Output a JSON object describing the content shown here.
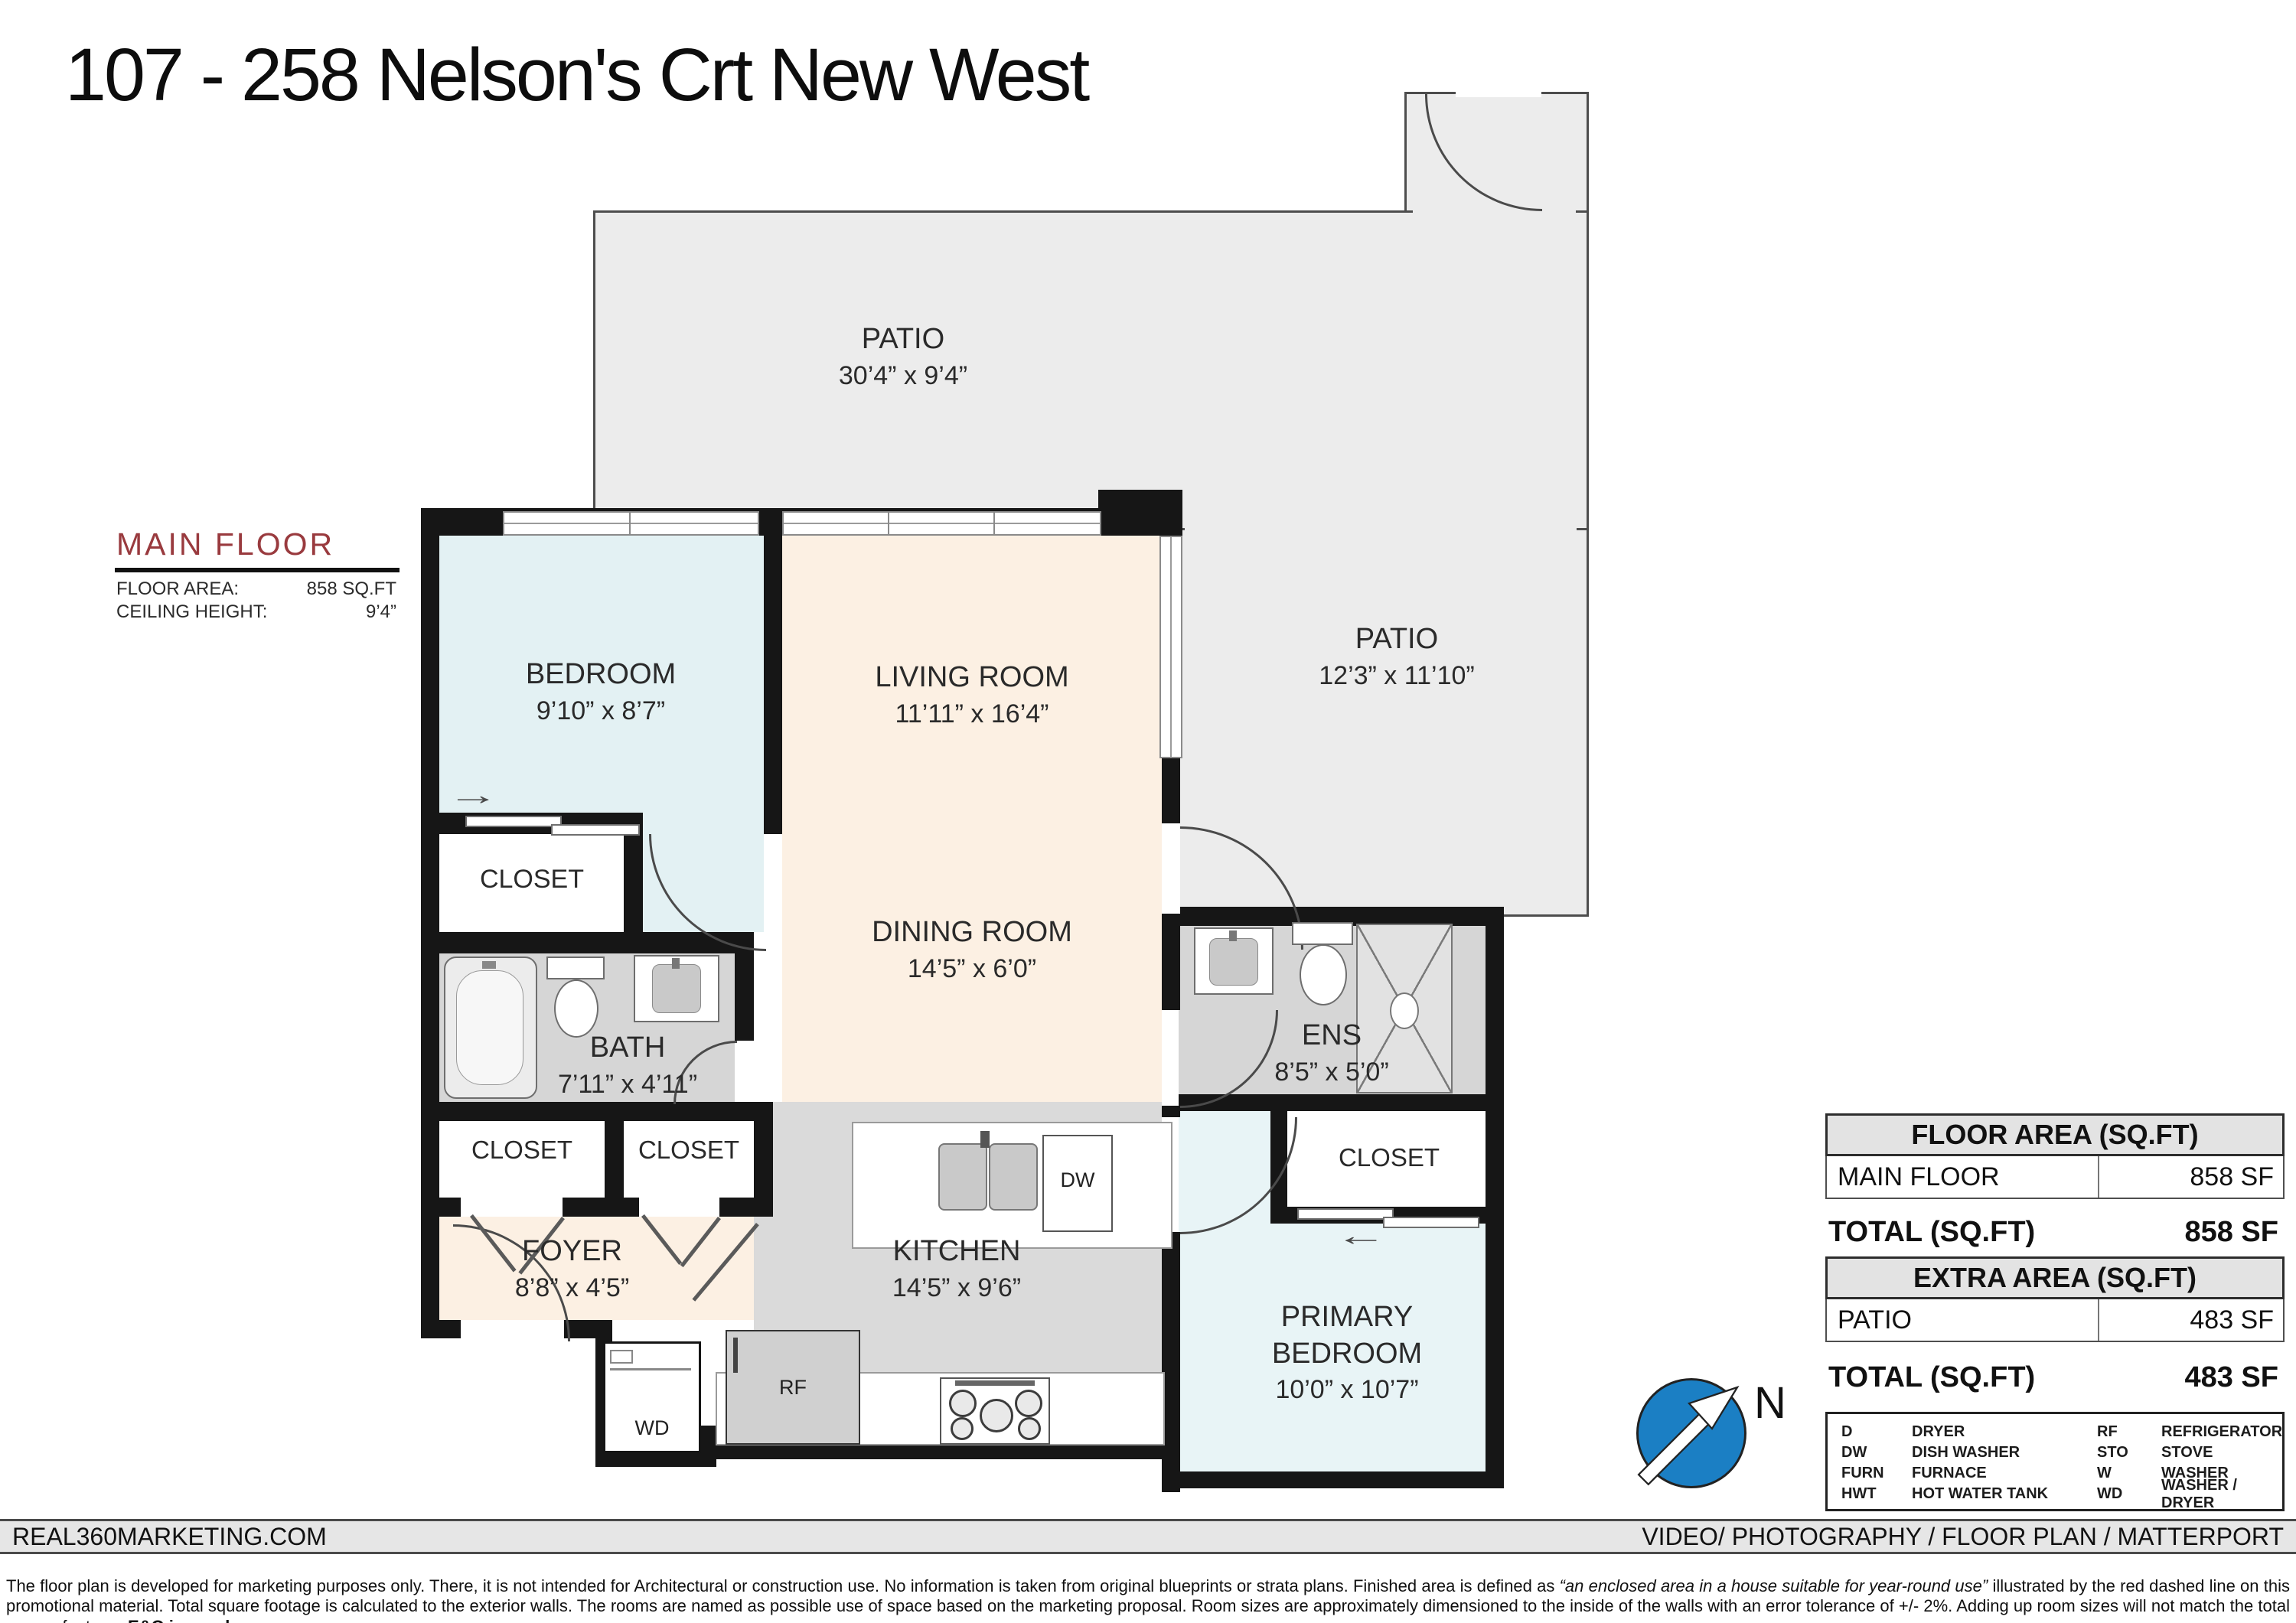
{
  "title": "107 - 258 Nelson's Crt New West",
  "floor_info": {
    "title": "MAIN FLOOR",
    "area_label": "FLOOR AREA:",
    "area_value": "858 SQ.FT",
    "ceiling_label": "CEILING HEIGHT:",
    "ceiling_value": "9’4”"
  },
  "rooms": {
    "patio_top": {
      "name": "PATIO",
      "dims": "30’4” x 9’4”"
    },
    "patio_right": {
      "name": "PATIO",
      "dims": "12’3” x 11’10”"
    },
    "bedroom": {
      "name": "BEDROOM",
      "dims": "9’10” x 8’7”"
    },
    "living_room": {
      "name": "LIVING ROOM",
      "dims": "11’11” x 16’4”"
    },
    "dining_room": {
      "name": "DINING ROOM",
      "dims": "14’5” x 6’0”"
    },
    "bath": {
      "name": "BATH",
      "dims": "7’11” x 4’11”"
    },
    "closet_bedroom": {
      "name": "CLOSET"
    },
    "closet_hall_1": {
      "name": "CLOSET"
    },
    "closet_hall_2": {
      "name": "CLOSET"
    },
    "foyer": {
      "name": "FOYER",
      "dims": "8’8” x 4’5”"
    },
    "kitchen": {
      "name": "KITCHEN",
      "dims": "14’5” x 9’6”"
    },
    "ens": {
      "name": "ENS",
      "dims": "8’5” x 5’0”"
    },
    "closet_primary": {
      "name": "CLOSET"
    },
    "primary_bedroom": {
      "name_line1": "PRIMARY",
      "name_line2": "BEDROOM",
      "dims": "10’0” x 10’7”"
    }
  },
  "appliances": {
    "wd": "WD",
    "rf": "RF",
    "dw": "DW"
  },
  "icons": {
    "slider_arrow_right": "→",
    "slider_arrow_left": "←"
  },
  "compass": {
    "north_label": "N"
  },
  "area_table": {
    "floor_header": "FLOOR AREA (SQ.FT)",
    "main_row": {
      "label": "MAIN FLOOR",
      "value": "858 SF"
    },
    "total1_label": "TOTAL (SQ.FT)",
    "total1_value": "858 SF",
    "extra_header": "EXTRA AREA (SQ.FT)",
    "patio_row": {
      "label": "PATIO",
      "value": "483 SF"
    },
    "total2_label": "TOTAL (SQ.FT)",
    "total2_value": "483 SF"
  },
  "legend": {
    "col1": [
      {
        "abbr": "D",
        "label": "DRYER"
      },
      {
        "abbr": "DW",
        "label": "DISH WASHER"
      },
      {
        "abbr": "FURN",
        "label": "FURNACE"
      },
      {
        "abbr": "HWT",
        "label": "HOT WATER TANK"
      }
    ],
    "col2": [
      {
        "abbr": "RF",
        "label": "REFRIGERATOR"
      },
      {
        "abbr": "STO",
        "label": "STOVE"
      },
      {
        "abbr": "W",
        "label": "WASHER"
      },
      {
        "abbr": "WD",
        "label": "WASHER / DRYER"
      }
    ]
  },
  "footer": {
    "left": "REAL360MARKETING.COM",
    "right": "VIDEO/ PHOTOGRAPHY / FLOOR PLAN / MATTERPORT"
  },
  "disclaimer": {
    "segments": [
      {
        "style": "normal",
        "text": "The floor plan is developed for marketing purposes only. There, it is not intended for Architectural or construction use. No information is taken from original blueprints or strata plans. Finished area is defined as "
      },
      {
        "style": "italic",
        "text": "“an enclosed area in a house suitable for year-round use”"
      },
      {
        "style": "normal",
        "text": " illustrated by the red dashed line on this promotional material. Total square footage is calculated to the exterior walls. The rooms are named as possible use of space based on the marketing proposal. Room sizes are approximately dimensioned to the inside of the walls with an error tolerance of +/- 2%. Adding up room sizes will not match the total square footage. "
      },
      {
        "style": "bold-underline",
        "text": "E&O insured."
      }
    ]
  },
  "colors": {
    "main_floor_red": "#993a3e",
    "compass_blue": "#1b7fc4",
    "patio_fill": "#ececec",
    "bedroom_fill": "#e3f1f3",
    "living_fill": "#fcf0e3",
    "kitchen_fill": "#dadada",
    "bath_fill": "#d6d6d6",
    "wall": "#161616"
  }
}
